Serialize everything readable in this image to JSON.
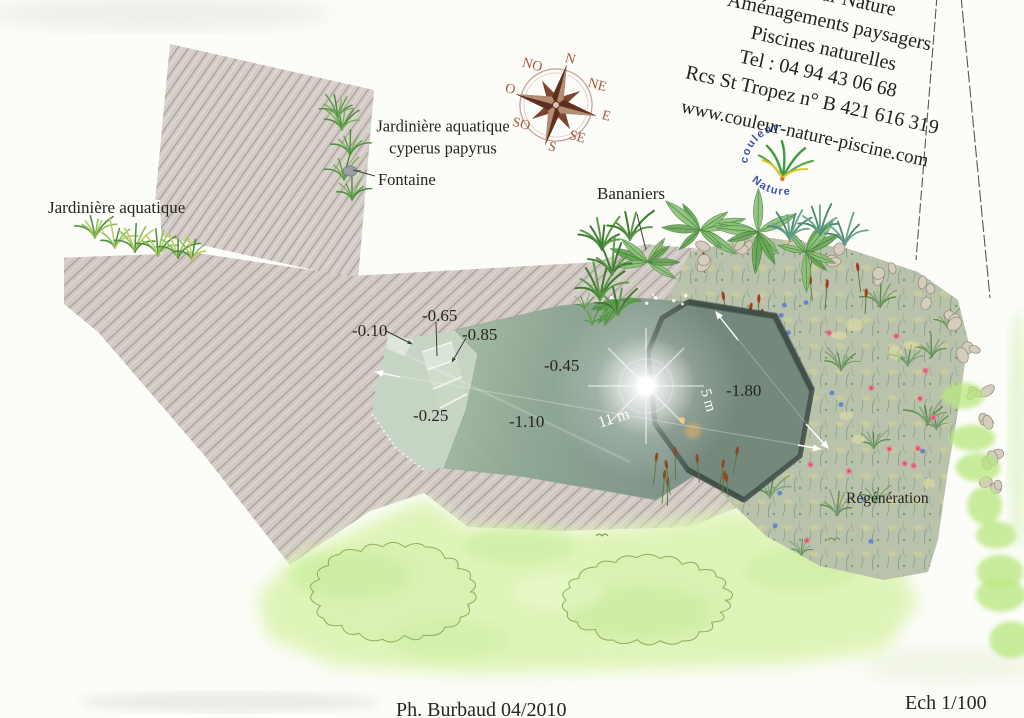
{
  "plan": {
    "company": {
      "name": "Couleur Nature",
      "line2": "Aménagements paysagers",
      "line3": "Piscines naturelles",
      "line4": "Tel : 04 94 43 06 68",
      "line5": "Rcs St Tropez n° B 421 616 319",
      "line6": "www.couleur-nature-piscine.com"
    },
    "logo": {
      "word1": "couleur",
      "word2": "Nature"
    },
    "compass": {
      "n": "N",
      "ne": "NE",
      "e": "E",
      "se": "SE",
      "s": "S",
      "so": "SO",
      "o": "O",
      "no": "NO"
    },
    "labels": {
      "jardiniere_left": "Jardinière aquatique",
      "jardiniere_cyperus_1": "Jardinière aquatique",
      "jardiniere_cyperus_2": "cyperus papyrus",
      "fontaine": "Fontaine",
      "bananiers": "Bananiers",
      "regeneration": "Régénération"
    },
    "depths": {
      "d010": "-0.10",
      "d065": "-0.65",
      "d085": "-0.85",
      "d045": "-0.45",
      "d025": "-0.25",
      "d110": "-1.10",
      "d180": "-1.80"
    },
    "dimensions": {
      "length": "11 m",
      "width": "5 m"
    },
    "footer": {
      "credit": "Ph. Burbaud 04/2010",
      "scale": "Ech 1/100"
    },
    "colors": {
      "deck": "#d2cac4",
      "pool_shallow": "#c6d4c4",
      "pool_mid": "#8fa794",
      "pool_deep": "#74887b",
      "pool_rim": "#44524a",
      "lawn": "#def4b6",
      "regen": "#b9c3ac",
      "logo_blue": "#3853b8",
      "compass_red": "#a8553e"
    }
  }
}
